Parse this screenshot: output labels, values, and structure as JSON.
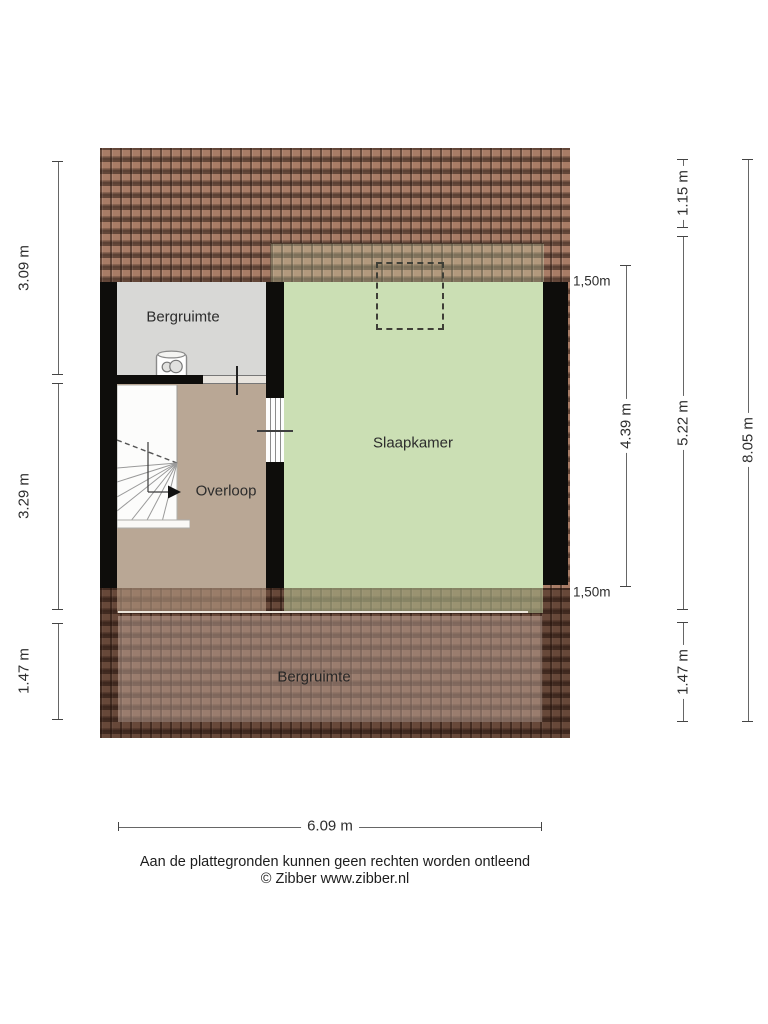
{
  "rooms": {
    "top_storage": "Bergruimte",
    "bedroom": "Slaapkamer",
    "landing": "Overloop",
    "bottom_storage": "Bergruimte"
  },
  "height_markers": {
    "top": "1,50m",
    "bottom": "1,50m"
  },
  "dimensions": {
    "left_top": "3.09 m",
    "left_middle": "3.29 m",
    "left_bottom": "1.47 m",
    "bedroom_inner": "4.39 m",
    "right_top": "1.15 m",
    "right_middle": "5.22 m",
    "right_bottom": "1.47 m",
    "right_total": "8.05 m",
    "bottom_width": "6.09 m"
  },
  "footer": {
    "disclaimer": "Aan de plattegronden kunnen geen rechten worden ontleend",
    "copyright": "© Zibber www.zibber.nl"
  },
  "colors": {
    "roof": "#a87c66",
    "wall": "#0e0d0b",
    "bedroom": "#cbdfb4",
    "storage": "#d8d8d6",
    "landing": "#b9a795"
  }
}
